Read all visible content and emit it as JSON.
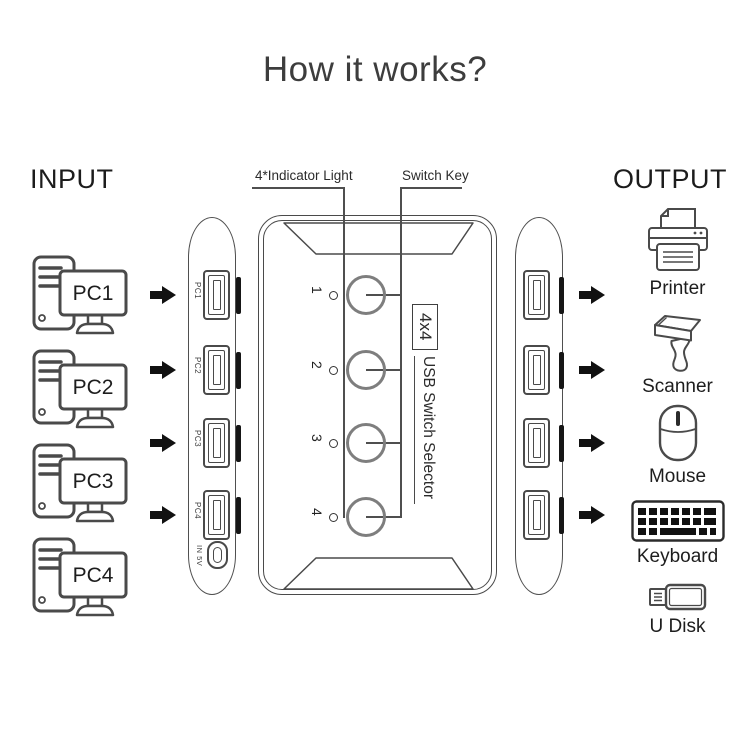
{
  "title": "How it works?",
  "colors": {
    "background": "#ffffff",
    "ink": "#4a4a4a",
    "text": "#1f1f1f",
    "button_stroke": "#7e7e7e",
    "arrow_fill": "#111111"
  },
  "input": {
    "heading": "INPUT",
    "pcs": [
      {
        "label": "PC1",
        "icon": "desktop-pc-icon"
      },
      {
        "label": "PC2",
        "icon": "desktop-pc-icon"
      },
      {
        "label": "PC3",
        "icon": "desktop-pc-icon"
      },
      {
        "label": "PC4",
        "icon": "desktop-pc-icon"
      }
    ]
  },
  "device": {
    "annotations": {
      "indicator_light": "4*Indicator Light",
      "switch_key": "Switch Key"
    },
    "port_labels": [
      "PC1",
      "PC2",
      "PC3",
      "PC4"
    ],
    "power_label": "IN 5V",
    "button_labels": [
      "1",
      "2",
      "3",
      "4"
    ],
    "model": "4x4",
    "name": "USB Switch Selector",
    "icons": {
      "input_port": "usb-a-port-icon",
      "output_port": "usb-a-port-icon",
      "power_port": "usb-c-port-icon",
      "flow": "right-arrow-icon"
    }
  },
  "output": {
    "heading": "OUTPUT",
    "devices": [
      {
        "name": "Printer",
        "icon": "printer-icon"
      },
      {
        "name": "Scanner",
        "icon": "barcode-scanner-icon"
      },
      {
        "name": "Mouse",
        "icon": "mouse-icon"
      },
      {
        "name": "Keyboard",
        "icon": "keyboard-icon"
      },
      {
        "name": "U Disk",
        "icon": "usb-drive-icon"
      }
    ]
  }
}
